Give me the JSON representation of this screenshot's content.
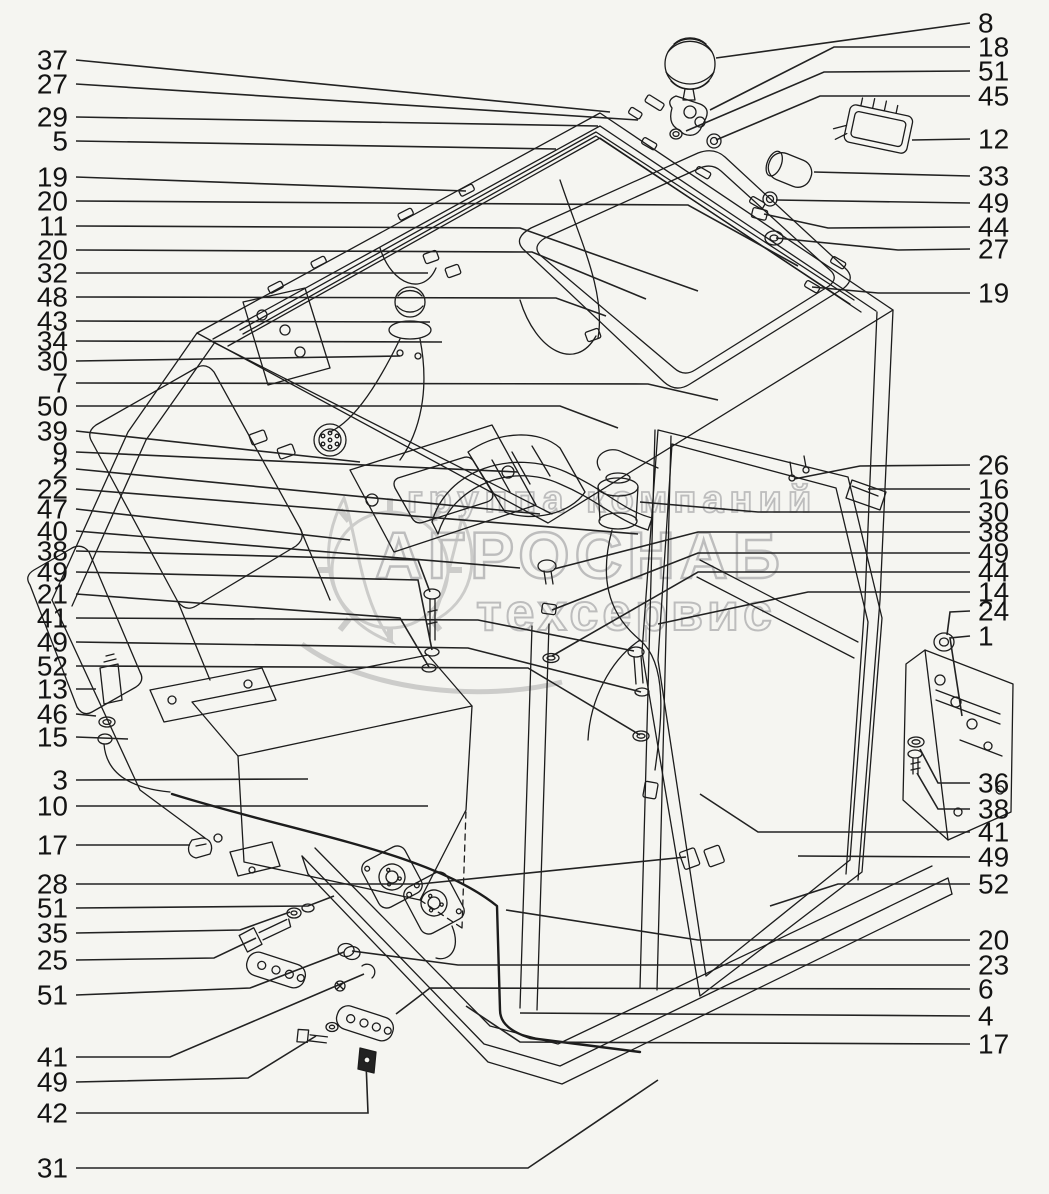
{
  "page": {
    "width": 1049,
    "height": 1194,
    "background": "#f5f5f1"
  },
  "diagram": {
    "kind": "exploded-parts-diagram",
    "subject": "truck cab electrical equipment installation",
    "line_color": "#1c1c1c",
    "leader_color": "#222222",
    "label_color": "#141414",
    "label_font_size": 28
  },
  "watermark": {
    "color": "#bdbdbd",
    "lines": [
      {
        "text": "группа компаний",
        "x": 612,
        "y": 512,
        "size": 38,
        "spacing": 6,
        "stroke_width": 1.8
      },
      {
        "text": "АГРОСНАБ",
        "x": 580,
        "y": 578,
        "size": 66,
        "spacing": 5,
        "stroke_width": 2.4
      },
      {
        "text": "техсервис",
        "x": 626,
        "y": 630,
        "size": 52,
        "spacing": 4,
        "stroke_width": 2.0
      }
    ]
  },
  "callouts": {
    "left": [
      {
        "label": "37",
        "y": 60,
        "leader": [
          [
            76,
            60
          ],
          [
            610,
            112
          ]
        ]
      },
      {
        "label": "27",
        "y": 84,
        "leader": [
          [
            76,
            84
          ],
          [
            638,
            120
          ]
        ]
      },
      {
        "label": "29",
        "y": 117,
        "leader": [
          [
            76,
            117
          ],
          [
            598,
            126
          ]
        ]
      },
      {
        "label": "5",
        "y": 141,
        "leader": [
          [
            76,
            141
          ],
          [
            556,
            149
          ]
        ]
      },
      {
        "label": "19",
        "y": 177,
        "leader": [
          [
            76,
            177
          ],
          [
            466,
            191
          ]
        ]
      },
      {
        "label": "20",
        "y": 201,
        "leader": [
          [
            76,
            201
          ],
          [
            688,
            205
          ],
          [
            798,
            266
          ]
        ]
      },
      {
        "label": "11",
        "y": 226,
        "leader": [
          [
            76,
            226
          ],
          [
            520,
            228
          ],
          [
            698,
            291
          ]
        ]
      },
      {
        "label": "20",
        "y": 250,
        "leader": [
          [
            76,
            250
          ],
          [
            532,
            252
          ],
          [
            646,
            299
          ]
        ]
      },
      {
        "label": "32",
        "y": 273,
        "leader": [
          [
            76,
            273
          ],
          [
            428,
            273
          ]
        ]
      },
      {
        "label": "48",
        "y": 297,
        "leader": [
          [
            76,
            297
          ],
          [
            556,
            298
          ],
          [
            606,
            316
          ]
        ]
      },
      {
        "label": "43",
        "y": 321,
        "leader": [
          [
            76,
            321
          ],
          [
            430,
            322
          ]
        ]
      },
      {
        "label": "34",
        "y": 341,
        "leader": [
          [
            76,
            341
          ],
          [
            442,
            342
          ]
        ]
      },
      {
        "label": "30",
        "y": 361,
        "leader": [
          [
            76,
            361
          ],
          [
            400,
            356
          ]
        ]
      },
      {
        "label": "7",
        "y": 383,
        "leader": [
          [
            76,
            383
          ],
          [
            648,
            384
          ],
          [
            718,
            400
          ]
        ]
      },
      {
        "label": "50",
        "y": 406,
        "leader": [
          [
            76,
            406
          ],
          [
            560,
            406
          ],
          [
            618,
            428
          ]
        ]
      },
      {
        "label": "39",
        "y": 431,
        "leader": [
          [
            76,
            431
          ],
          [
            360,
            462
          ]
        ]
      },
      {
        "label": "9",
        "y": 452,
        "leader": [
          [
            76,
            452
          ],
          [
            518,
            472
          ]
        ]
      },
      {
        "label": "2",
        "y": 469,
        "leader": [
          [
            76,
            469
          ],
          [
            540,
            514
          ]
        ]
      },
      {
        "label": "22",
        "y": 489,
        "leader": [
          [
            76,
            489
          ],
          [
            638,
            534
          ]
        ]
      },
      {
        "label": "47",
        "y": 509,
        "leader": [
          [
            76,
            509
          ],
          [
            350,
            540
          ]
        ]
      },
      {
        "label": "40",
        "y": 531,
        "leader": [
          [
            76,
            531
          ],
          [
            520,
            568
          ]
        ]
      },
      {
        "label": "38",
        "y": 551,
        "leader": [
          [
            76,
            551
          ],
          [
            418,
            560
          ],
          [
            430,
            592
          ]
        ]
      },
      {
        "label": "49",
        "y": 572,
        "leader": [
          [
            76,
            572
          ],
          [
            418,
            580
          ],
          [
            432,
            650
          ]
        ]
      },
      {
        "label": "21",
        "y": 594,
        "leader": [
          [
            76,
            594
          ],
          [
            400,
            618
          ],
          [
            429,
            667
          ]
        ]
      },
      {
        "label": "41",
        "y": 618,
        "leader": [
          [
            76,
            618
          ],
          [
            478,
            620
          ],
          [
            634,
            651
          ]
        ]
      },
      {
        "label": "49",
        "y": 642,
        "leader": [
          [
            76,
            642
          ],
          [
            468,
            648
          ],
          [
            641,
            692
          ]
        ]
      },
      {
        "label": "52",
        "y": 666,
        "leader": [
          [
            76,
            666
          ],
          [
            528,
            668
          ],
          [
            640,
            735
          ]
        ]
      },
      {
        "label": "13",
        "y": 689,
        "leader": [
          [
            76,
            689
          ],
          [
            96,
            689
          ]
        ]
      },
      {
        "label": "46",
        "y": 714,
        "leader": [
          [
            76,
            714
          ],
          [
            96,
            716
          ]
        ]
      },
      {
        "label": "15",
        "y": 737,
        "leader": [
          [
            76,
            737
          ],
          [
            128,
            739
          ]
        ]
      },
      {
        "label": "3",
        "y": 780,
        "leader": [
          [
            76,
            780
          ],
          [
            308,
            779
          ]
        ]
      },
      {
        "label": "10",
        "y": 806,
        "leader": [
          [
            76,
            806
          ],
          [
            428,
            806
          ]
        ]
      },
      {
        "label": "17",
        "y": 845,
        "leader": [
          [
            76,
            845
          ],
          [
            190,
            845
          ]
        ]
      },
      {
        "label": "28",
        "y": 884,
        "leader": [
          [
            76,
            884
          ],
          [
            420,
            884
          ],
          [
            686,
            857
          ]
        ]
      },
      {
        "label": "51",
        "y": 908,
        "leader": [
          [
            76,
            908
          ],
          [
            308,
            906
          ],
          [
            334,
            896
          ]
        ]
      },
      {
        "label": "35",
        "y": 933,
        "leader": [
          [
            76,
            933
          ],
          [
            240,
            930
          ],
          [
            290,
            912
          ]
        ]
      },
      {
        "label": "25",
        "y": 960,
        "leader": [
          [
            76,
            960
          ],
          [
            214,
            958
          ],
          [
            256,
            938
          ]
        ]
      },
      {
        "label": "51",
        "y": 995,
        "leader": [
          [
            76,
            995
          ],
          [
            250,
            988
          ],
          [
            344,
            952
          ]
        ]
      },
      {
        "label": "41",
        "y": 1057,
        "leader": [
          [
            76,
            1057
          ],
          [
            170,
            1057
          ],
          [
            364,
            974
          ]
        ]
      },
      {
        "label": "49",
        "y": 1082,
        "leader": [
          [
            76,
            1082
          ],
          [
            248,
            1078
          ],
          [
            316,
            1036
          ]
        ]
      },
      {
        "label": "42",
        "y": 1113,
        "leader": [
          [
            76,
            1113
          ],
          [
            368,
            1113
          ],
          [
            366,
            1062
          ]
        ]
      },
      {
        "label": "31",
        "y": 1168,
        "leader": [
          [
            76,
            1168
          ],
          [
            528,
            1168
          ],
          [
            658,
            1080
          ]
        ]
      }
    ],
    "right": [
      {
        "label": "8",
        "y": 23,
        "leader": [
          [
            970,
            23
          ],
          [
            716,
            58
          ]
        ]
      },
      {
        "label": "18",
        "y": 47,
        "leader": [
          [
            970,
            47
          ],
          [
            834,
            47
          ],
          [
            710,
            110
          ]
        ]
      },
      {
        "label": "51",
        "y": 71,
        "leader": [
          [
            970,
            71
          ],
          [
            824,
            72
          ],
          [
            686,
            131
          ]
        ]
      },
      {
        "label": "45",
        "y": 96,
        "leader": [
          [
            970,
            96
          ],
          [
            820,
            96
          ],
          [
            716,
            140
          ]
        ]
      },
      {
        "label": "12",
        "y": 139,
        "leader": [
          [
            970,
            139
          ],
          [
            912,
            140
          ]
        ]
      },
      {
        "label": "33",
        "y": 176,
        "leader": [
          [
            970,
            176
          ],
          [
            814,
            172
          ]
        ]
      },
      {
        "label": "49",
        "y": 203,
        "leader": [
          [
            970,
            203
          ],
          [
            776,
            200
          ]
        ]
      },
      {
        "label": "44",
        "y": 227,
        "leader": [
          [
            970,
            227
          ],
          [
            828,
            228
          ],
          [
            764,
            214
          ]
        ]
      },
      {
        "label": "27",
        "y": 249,
        "leader": [
          [
            970,
            249
          ],
          [
            898,
            250
          ],
          [
            776,
            238
          ]
        ]
      },
      {
        "label": "19",
        "y": 293,
        "leader": [
          [
            970,
            293
          ],
          [
            878,
            293
          ],
          [
            812,
            287
          ]
        ]
      },
      {
        "label": "26",
        "y": 465,
        "leader": [
          [
            970,
            465
          ],
          [
            860,
            466
          ],
          [
            794,
            479
          ]
        ]
      },
      {
        "label": "16",
        "y": 489,
        "leader": [
          [
            970,
            489
          ],
          [
            868,
            489
          ]
        ]
      },
      {
        "label": "30",
        "y": 512,
        "leader": [
          [
            970,
            512
          ],
          [
            758,
            512
          ],
          [
            640,
            502
          ]
        ]
      },
      {
        "label": "38",
        "y": 532,
        "leader": [
          [
            970,
            532
          ],
          [
            698,
            532
          ],
          [
            554,
            569
          ]
        ]
      },
      {
        "label": "49",
        "y": 553,
        "leader": [
          [
            970,
            553
          ],
          [
            698,
            553
          ],
          [
            552,
            610
          ]
        ]
      },
      {
        "label": "44",
        "y": 572,
        "leader": [
          [
            970,
            572
          ],
          [
            698,
            572
          ],
          [
            552,
            656
          ]
        ]
      },
      {
        "label": "14",
        "y": 592,
        "leader": [
          [
            970,
            592
          ],
          [
            808,
            592
          ],
          [
            658,
            624
          ]
        ]
      },
      {
        "label": "24",
        "y": 611,
        "leader": [
          [
            970,
            611
          ],
          [
            950,
            612
          ],
          [
            947,
            635
          ]
        ]
      },
      {
        "label": "1",
        "y": 636,
        "leader": [
          [
            970,
            636
          ],
          [
            950,
            638
          ],
          [
            962,
            716
          ]
        ]
      },
      {
        "label": "36",
        "y": 783,
        "leader": [
          [
            970,
            783
          ],
          [
            938,
            783
          ],
          [
            920,
            749
          ]
        ]
      },
      {
        "label": "38",
        "y": 809,
        "leader": [
          [
            970,
            809
          ],
          [
            938,
            809
          ],
          [
            917,
            773
          ]
        ]
      },
      {
        "label": "41",
        "y": 832,
        "leader": [
          [
            970,
            832
          ],
          [
            758,
            832
          ],
          [
            700,
            794
          ]
        ]
      },
      {
        "label": "49",
        "y": 857,
        "leader": [
          [
            970,
            857
          ],
          [
            798,
            856
          ]
        ]
      },
      {
        "label": "52",
        "y": 884,
        "leader": [
          [
            970,
            884
          ],
          [
            838,
            884
          ],
          [
            770,
            906
          ]
        ]
      },
      {
        "label": "20",
        "y": 940,
        "leader": [
          [
            970,
            940
          ],
          [
            698,
            940
          ],
          [
            506,
            910
          ]
        ]
      },
      {
        "label": "23",
        "y": 965,
        "leader": [
          [
            970,
            965
          ],
          [
            458,
            965
          ],
          [
            352,
            951
          ]
        ]
      },
      {
        "label": "6",
        "y": 989,
        "leader": [
          [
            970,
            989
          ],
          [
            430,
            988
          ],
          [
            396,
            1014
          ]
        ]
      },
      {
        "label": "4",
        "y": 1016,
        "leader": [
          [
            970,
            1016
          ],
          [
            520,
            1013
          ]
        ]
      },
      {
        "label": "17",
        "y": 1044,
        "leader": [
          [
            970,
            1044
          ],
          [
            520,
            1042
          ],
          [
            466,
            1006
          ]
        ]
      }
    ]
  }
}
